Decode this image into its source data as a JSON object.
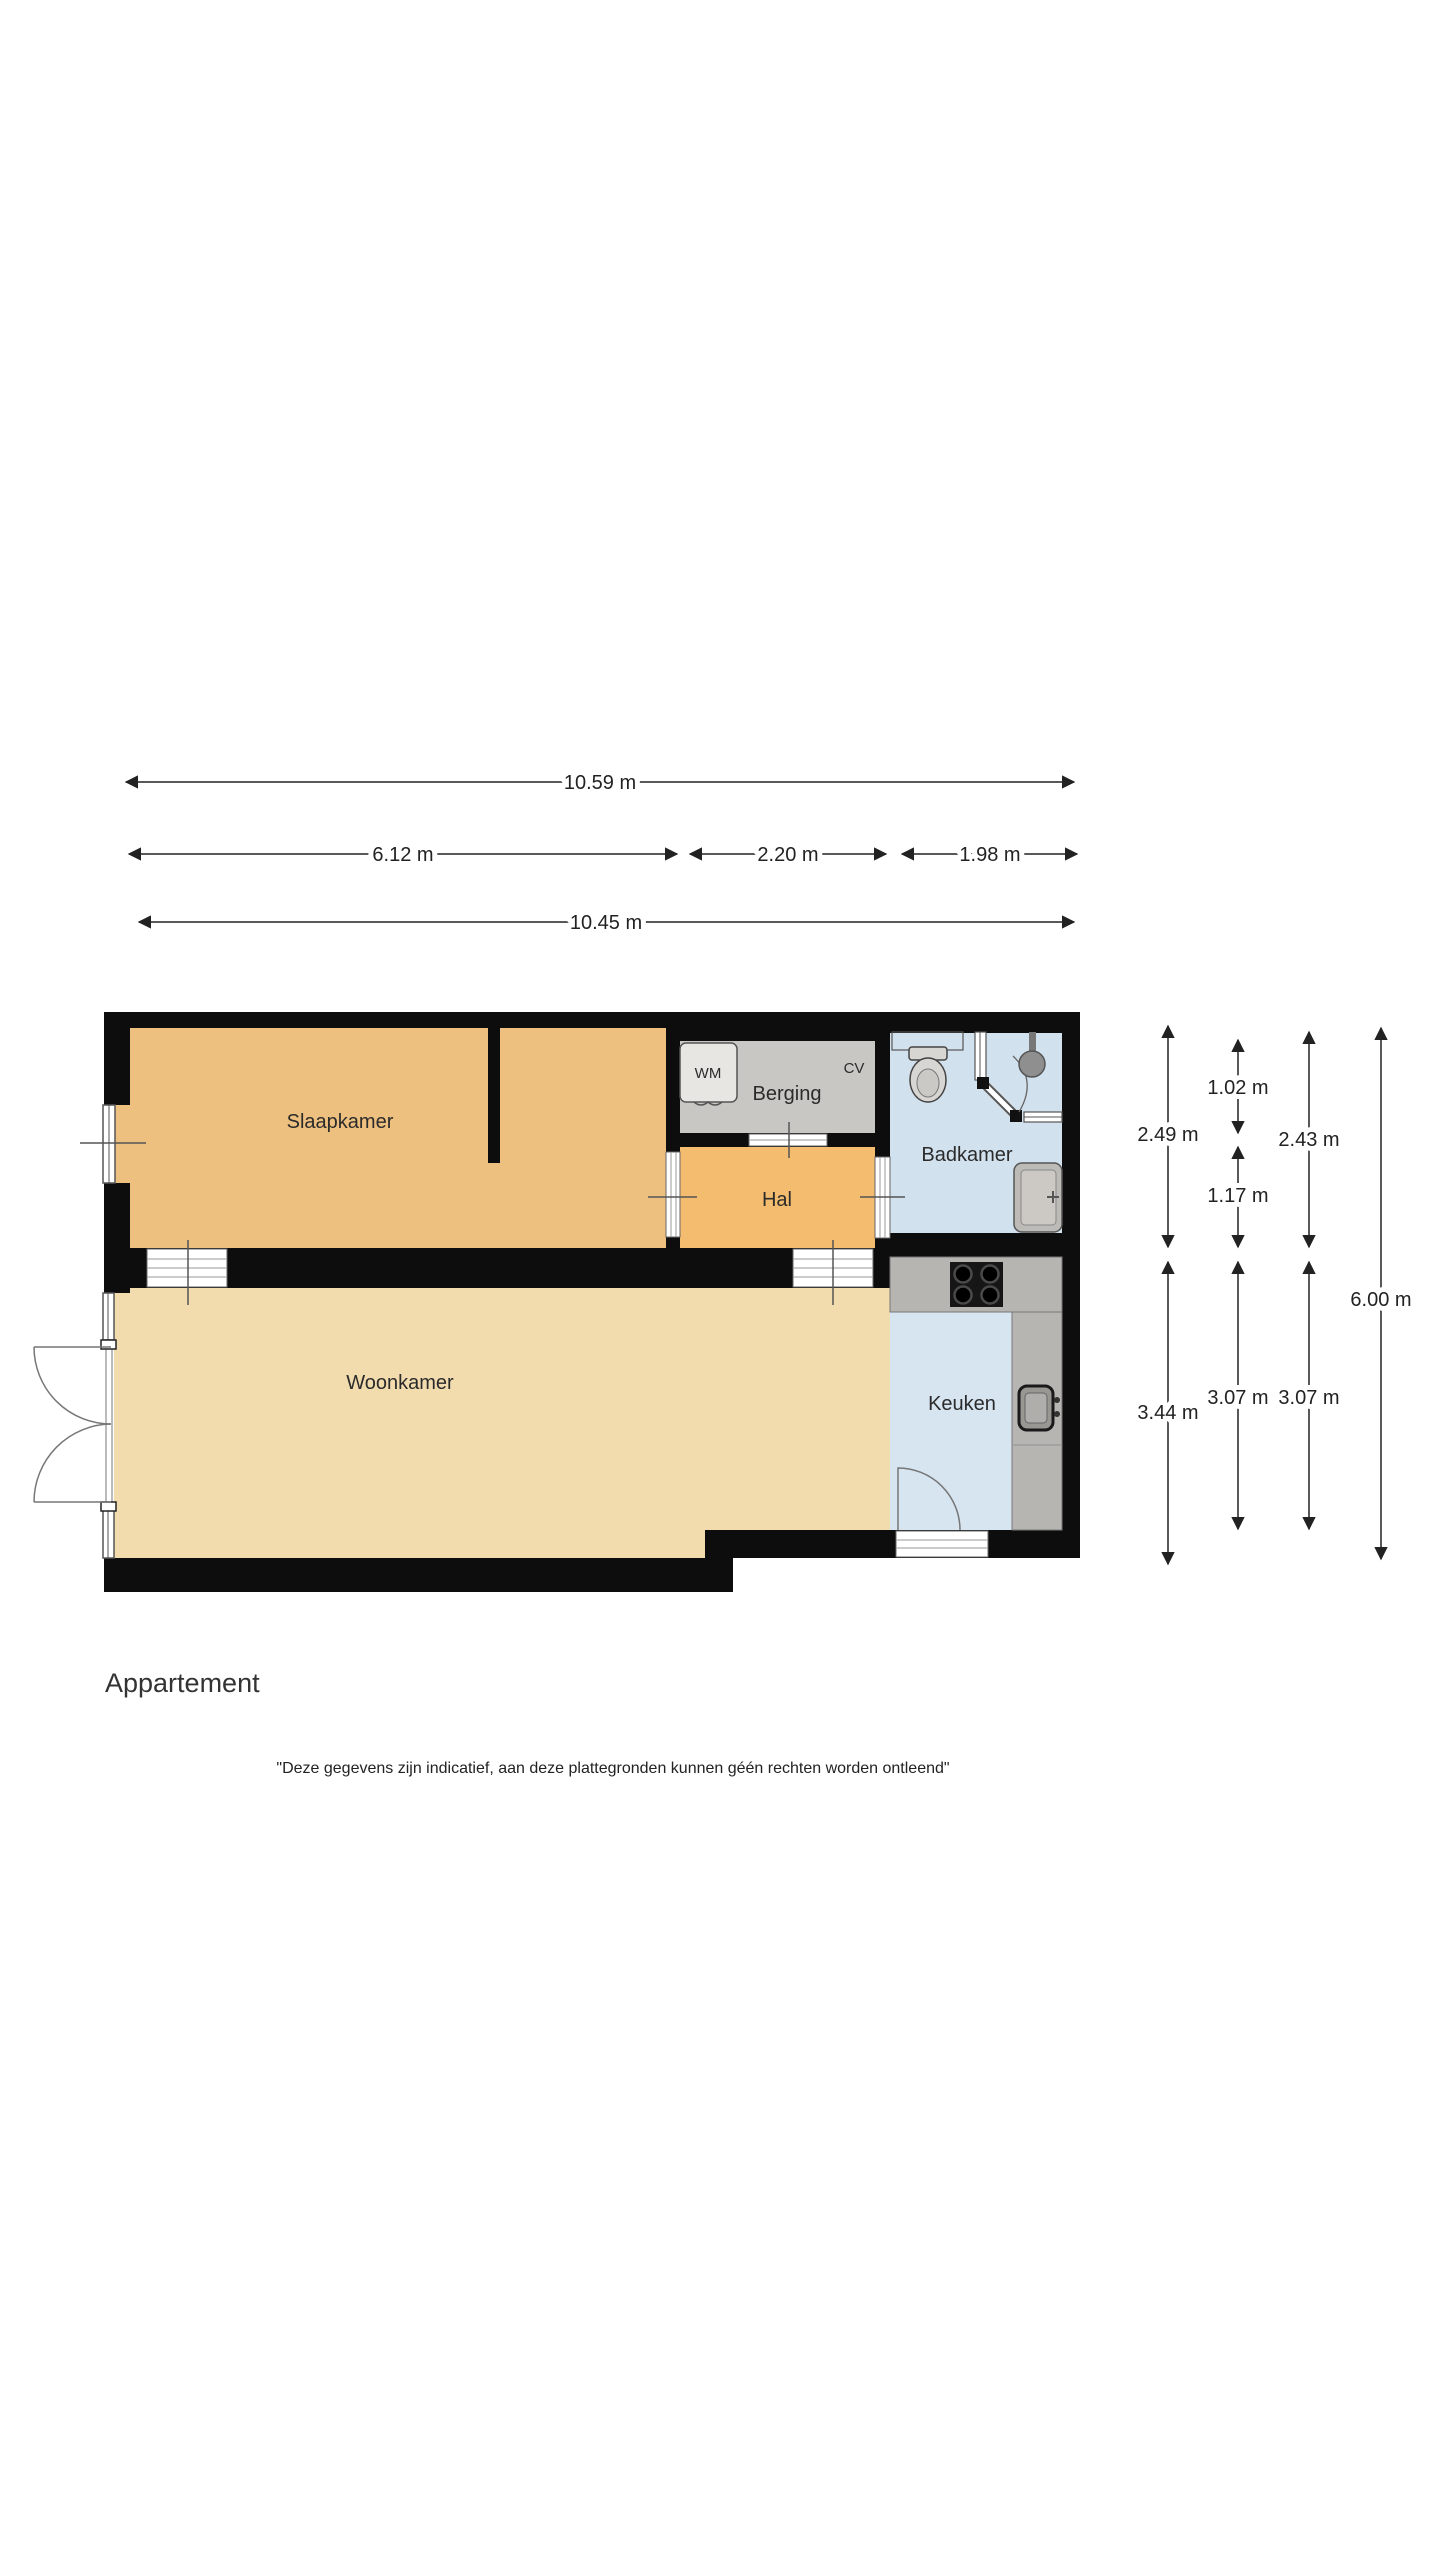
{
  "plan": {
    "title": "Appartement",
    "disclaimer": "\"Deze gegevens zijn indicatief, aan deze plattegronden kunnen géén rechten worden ontleend\"",
    "rooms": {
      "slaapkamer": "Slaapkamer",
      "woonkamer": "Woonkamer",
      "hal": "Hal",
      "berging": "Berging",
      "badkamer": "Badkamer",
      "keuken": "Keuken"
    },
    "appliances": {
      "wm": "WM",
      "cv": "CV"
    },
    "dims": {
      "total_top": "10.59 m",
      "seg_left": "6.12 m",
      "seg_mid": "2.20 m",
      "seg_right": "1.98 m",
      "total_bottom": "10.45 m",
      "right_col1_top": "2.49 m",
      "right_col2_top": "1.02 m",
      "right_col3_top": "2.43 m",
      "right_col2_mid": "1.17 m",
      "right_col1_bottom": "3.44 m",
      "right_col2_bottom": "3.07 m",
      "right_col3_bottom": "3.07 m",
      "right_total": "6.00 m"
    },
    "colors": {
      "wall": "#0d0d0d",
      "bedroom_floor": "#eec07f",
      "hal_floor": "#f4bc6e",
      "living_floor": "#f2dcae",
      "storage_floor": "#c9c7c3",
      "bath_floor": "#d2e1ee",
      "kitchen_floor": "#d7e5f1",
      "counter": "#b7b5b1",
      "fixture": "#d8d6d2",
      "dimension": "#222222"
    }
  }
}
